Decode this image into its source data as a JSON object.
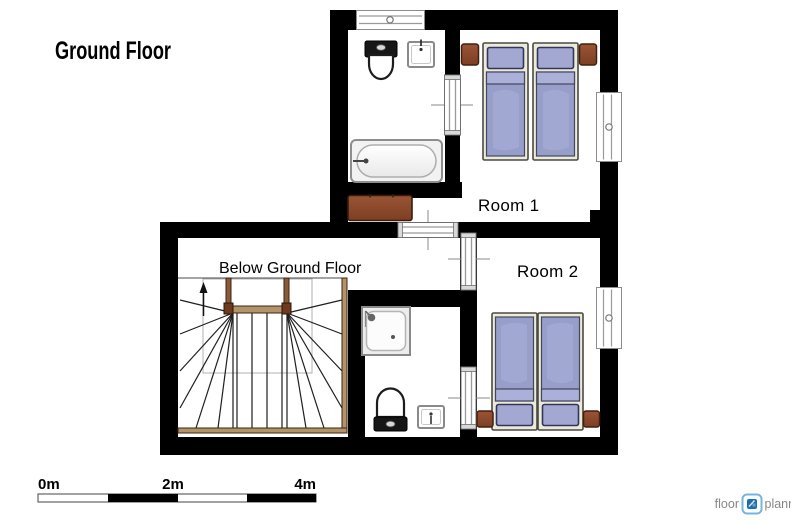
{
  "title": "Ground Floor",
  "floor_plan": {
    "room1_label": "Room 1",
    "room2_label": "Room 2",
    "stairwell_label": "Below Ground Floor"
  },
  "scale_bar": {
    "tick_0": "0m",
    "tick_2": "2m",
    "tick_4": "4m"
  },
  "logo": {
    "prefix": "floor",
    "suffix": "planner"
  },
  "colors": {
    "wall": "#000000",
    "floor": "#ffffff",
    "bed_linen": "#979ec9",
    "bed_pillow": "#a2a8d2",
    "bed_fold": "#aab0d8",
    "bed_frame": "#edeada",
    "wood_furniture": "#8d4a2e",
    "stair_wood": "#b29468",
    "logo_blue": "#1f6fae",
    "logo_border": "#74b6dd",
    "logo_text": "#878787"
  }
}
